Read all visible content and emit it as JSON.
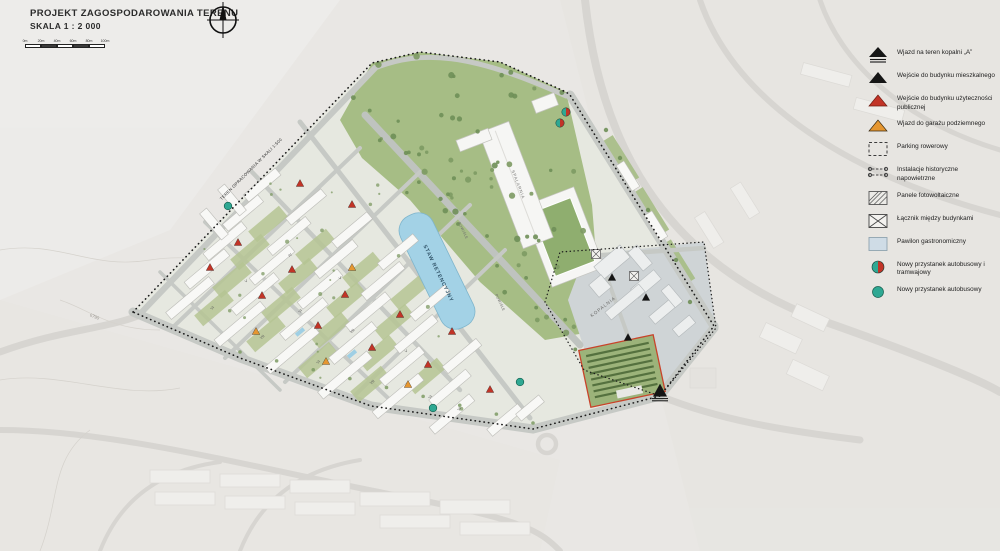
{
  "title_block": {
    "title": "PROJEKT ZAGOSPODAROWANIA TERENU",
    "scale": "SKALA 1 : 2 000"
  },
  "scale_bar": {
    "labels": [
      "0m",
      "20m",
      "40m",
      "60m",
      "80m",
      "100m"
    ]
  },
  "legend": {
    "items": [
      {
        "id": "mine-entry",
        "swatch": "tri-mine",
        "label": "Wjazd na teren kopalni „A”"
      },
      {
        "id": "dwelling-entry",
        "swatch": "tri-black",
        "label": "Wejście do budynku mieszkalnego"
      },
      {
        "id": "public-entry",
        "swatch": "tri-red",
        "label": "Wejście do budynku użyteczności publicznej"
      },
      {
        "id": "garage-entry",
        "swatch": "tri-orange",
        "label": "Wjazd do garażu podziemnego"
      },
      {
        "id": "bike-parking",
        "swatch": "sq-dashed",
        "label": "Parking rowerowy"
      },
      {
        "id": "historic-lines",
        "swatch": "line-hist",
        "label": "Instalacje historyczne napowietrzne"
      },
      {
        "id": "pv-panels",
        "swatch": "sq-hatch",
        "label": "Panele fotowoltaiczne"
      },
      {
        "id": "building-link",
        "swatch": "sq-x",
        "label": "Łącznik między budynkami"
      },
      {
        "id": "gastro-pavilion",
        "swatch": "sq-blue",
        "label": "Pawilon gastronomiczny"
      },
      {
        "id": "new-bus-tram-stop",
        "swatch": "circ-split",
        "label": "Nowy przystanek autobusowy i tramwajowy"
      },
      {
        "id": "new-bus-stop",
        "swatch": "circ-teal",
        "label": "Nowy przystanek autobusowy"
      }
    ]
  },
  "map": {
    "labels": [
      {
        "text": "STAW RETENCYJNY",
        "x": 437,
        "y": 274,
        "rot": 64,
        "size": 5.2,
        "color": "#33566b",
        "ls": 0.8,
        "w": 700
      },
      {
        "text": "TEREN OPRACOWANIA W SKALI 1:500",
        "x": 252,
        "y": 170,
        "rot": -45,
        "size": 4.2,
        "color": "#2e2e2e",
        "ls": 0.3
      },
      {
        "text": "KOPALNIA",
        "x": 604,
        "y": 308,
        "rot": -38,
        "size": 4.6,
        "color": "#6a6a68",
        "ls": 1
      },
      {
        "text": "SPALARNIA",
        "x": 517,
        "y": 185,
        "rot": 69,
        "size": 4.2,
        "color": "#767674",
        "ls": 0.8
      },
      {
        "text": "POWIŚLE",
        "x": 462,
        "y": 231,
        "rot": 64,
        "size": 3.6,
        "color": "#6f6f6d",
        "ls": 0.3
      },
      {
        "text": "POWIŚLE",
        "x": 499,
        "y": 303,
        "rot": 64,
        "size": 3.6,
        "color": "#6f6f6d",
        "ls": 0.3
      },
      {
        "text": "6790",
        "x": 94,
        "y": 318,
        "rot": 22,
        "size": 4.4,
        "color": "#98948e"
      },
      {
        "text": "VI",
        "x": 213,
        "y": 309,
        "rot": -40,
        "size": 3.8,
        "color": "#565656"
      },
      {
        "text": "VII",
        "x": 263,
        "y": 338,
        "rot": -40,
        "size": 3.8,
        "color": "#565656"
      },
      {
        "text": "VI",
        "x": 319,
        "y": 363,
        "rot": -40,
        "size": 3.8,
        "color": "#565656"
      },
      {
        "text": "VII",
        "x": 373,
        "y": 383,
        "rot": -40,
        "size": 3.8,
        "color": "#565656"
      },
      {
        "text": "VI",
        "x": 431,
        "y": 398,
        "rot": -40,
        "size": 3.8,
        "color": "#565656"
      },
      {
        "text": "V",
        "x": 247,
        "y": 282,
        "rot": -40,
        "size": 3.8,
        "color": "#565656"
      },
      {
        "text": "VI",
        "x": 301,
        "y": 312,
        "rot": -40,
        "size": 3.8,
        "color": "#565656"
      },
      {
        "text": "VII",
        "x": 353,
        "y": 332,
        "rot": -40,
        "size": 3.8,
        "color": "#565656"
      },
      {
        "text": "V",
        "x": 407,
        "y": 352,
        "rot": -40,
        "size": 3.8,
        "color": "#565656"
      },
      {
        "text": "IV",
        "x": 291,
        "y": 256,
        "rot": -40,
        "size": 3.8,
        "color": "#565656"
      },
      {
        "text": "V",
        "x": 341,
        "y": 279,
        "rot": -40,
        "size": 3.8,
        "color": "#565656"
      },
      {
        "text": "VI",
        "x": 460,
        "y": 410,
        "rot": -40,
        "size": 3.8,
        "color": "#565656"
      }
    ],
    "markers": [
      {
        "type": "stop-tram",
        "x": 566,
        "y": 112
      },
      {
        "type": "stop-tram",
        "x": 560,
        "y": 123
      },
      {
        "type": "stop-bus",
        "x": 228,
        "y": 206
      },
      {
        "type": "stop-bus",
        "x": 433,
        "y": 408
      },
      {
        "type": "stop-bus",
        "x": 520,
        "y": 382
      },
      {
        "type": "tri-mine",
        "x": 660,
        "y": 392
      },
      {
        "type": "tri-black",
        "x": 612,
        "y": 278
      },
      {
        "type": "tri-black",
        "x": 646,
        "y": 298
      },
      {
        "type": "tri-black",
        "x": 628,
        "y": 338
      },
      {
        "type": "tri-red",
        "x": 210,
        "y": 268
      },
      {
        "type": "tri-red",
        "x": 262,
        "y": 296
      },
      {
        "type": "tri-red",
        "x": 318,
        "y": 326
      },
      {
        "type": "tri-red",
        "x": 372,
        "y": 348
      },
      {
        "type": "tri-red",
        "x": 428,
        "y": 365
      },
      {
        "type": "tri-red",
        "x": 238,
        "y": 243
      },
      {
        "type": "tri-red",
        "x": 292,
        "y": 270
      },
      {
        "type": "tri-red",
        "x": 345,
        "y": 295
      },
      {
        "type": "tri-red",
        "x": 400,
        "y": 315
      },
      {
        "type": "tri-red",
        "x": 300,
        "y": 184
      },
      {
        "type": "tri-red",
        "x": 352,
        "y": 205
      },
      {
        "type": "tri-red",
        "x": 452,
        "y": 332
      },
      {
        "type": "tri-red",
        "x": 490,
        "y": 390
      },
      {
        "type": "tri-orange",
        "x": 256,
        "y": 332
      },
      {
        "type": "tri-orange",
        "x": 326,
        "y": 362
      },
      {
        "type": "tri-orange",
        "x": 408,
        "y": 385
      },
      {
        "type": "tri-orange",
        "x": 352,
        "y": 268
      }
    ]
  },
  "colors": {
    "accent_red": "#c23427",
    "accent_orange": "#e59630",
    "accent_teal": "#2fa893",
    "park_green": "#a6bd85",
    "water_blue": "#a3d2e6"
  }
}
